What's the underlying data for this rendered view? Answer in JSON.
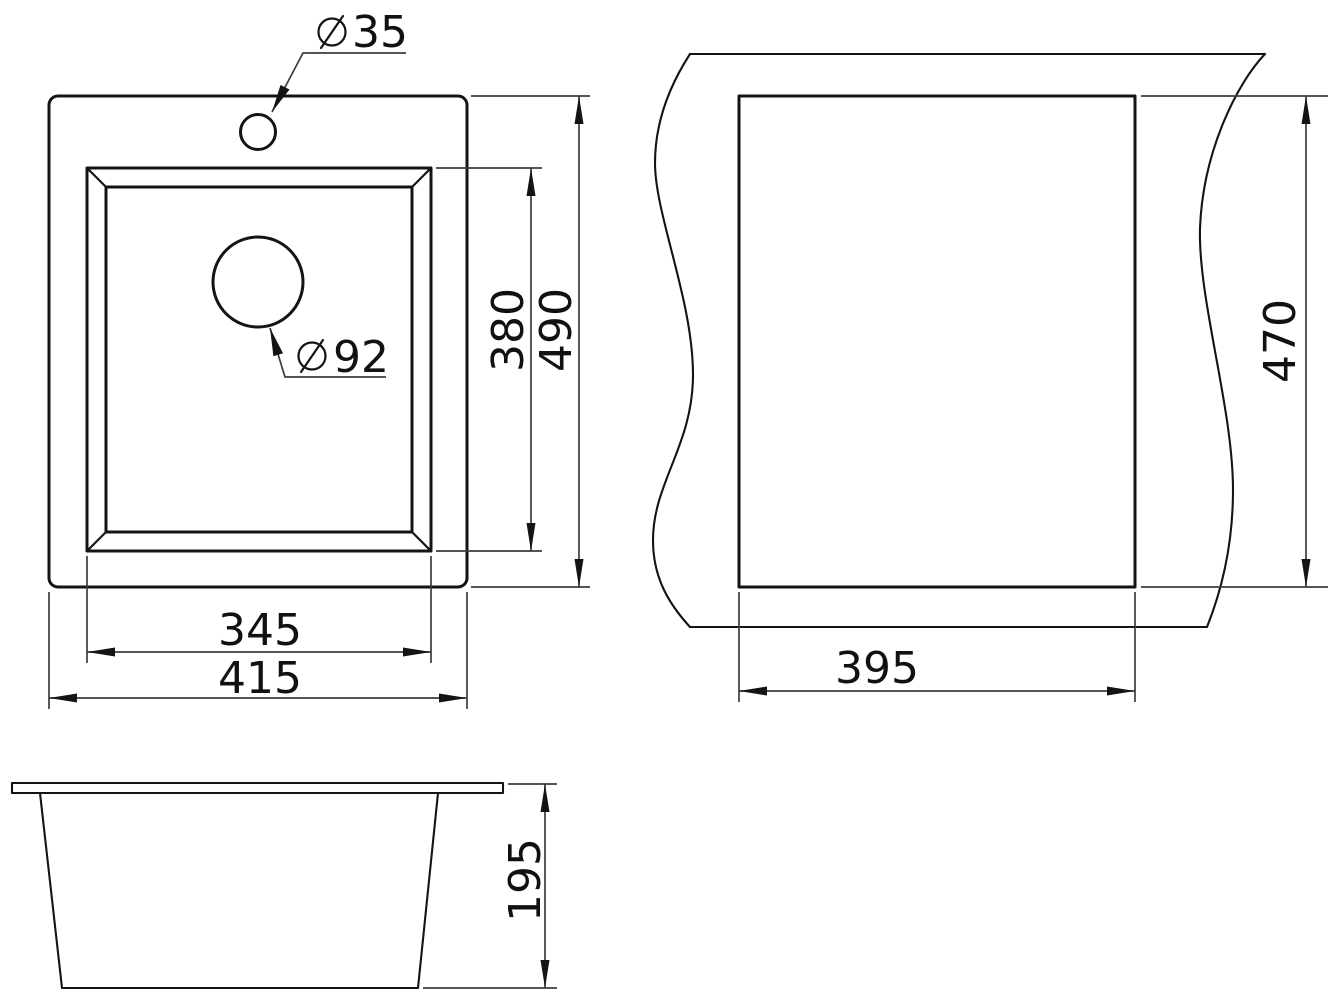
{
  "dimensions": {
    "diameter_symbol": "⌀",
    "faucet_hole_diameter": "35",
    "drain_hole_diameter": "92",
    "top_view": {
      "bowl_length": "380",
      "overall_length": "490",
      "bowl_width": "345",
      "overall_width": "415"
    },
    "cutout_view": {
      "length": "470",
      "width": "395"
    },
    "front_view": {
      "depth": "195"
    }
  },
  "colors": {
    "object_line": "#141414",
    "dimension_line": "#3d3d3d",
    "text": "#111111",
    "background": "#ffffff"
  }
}
